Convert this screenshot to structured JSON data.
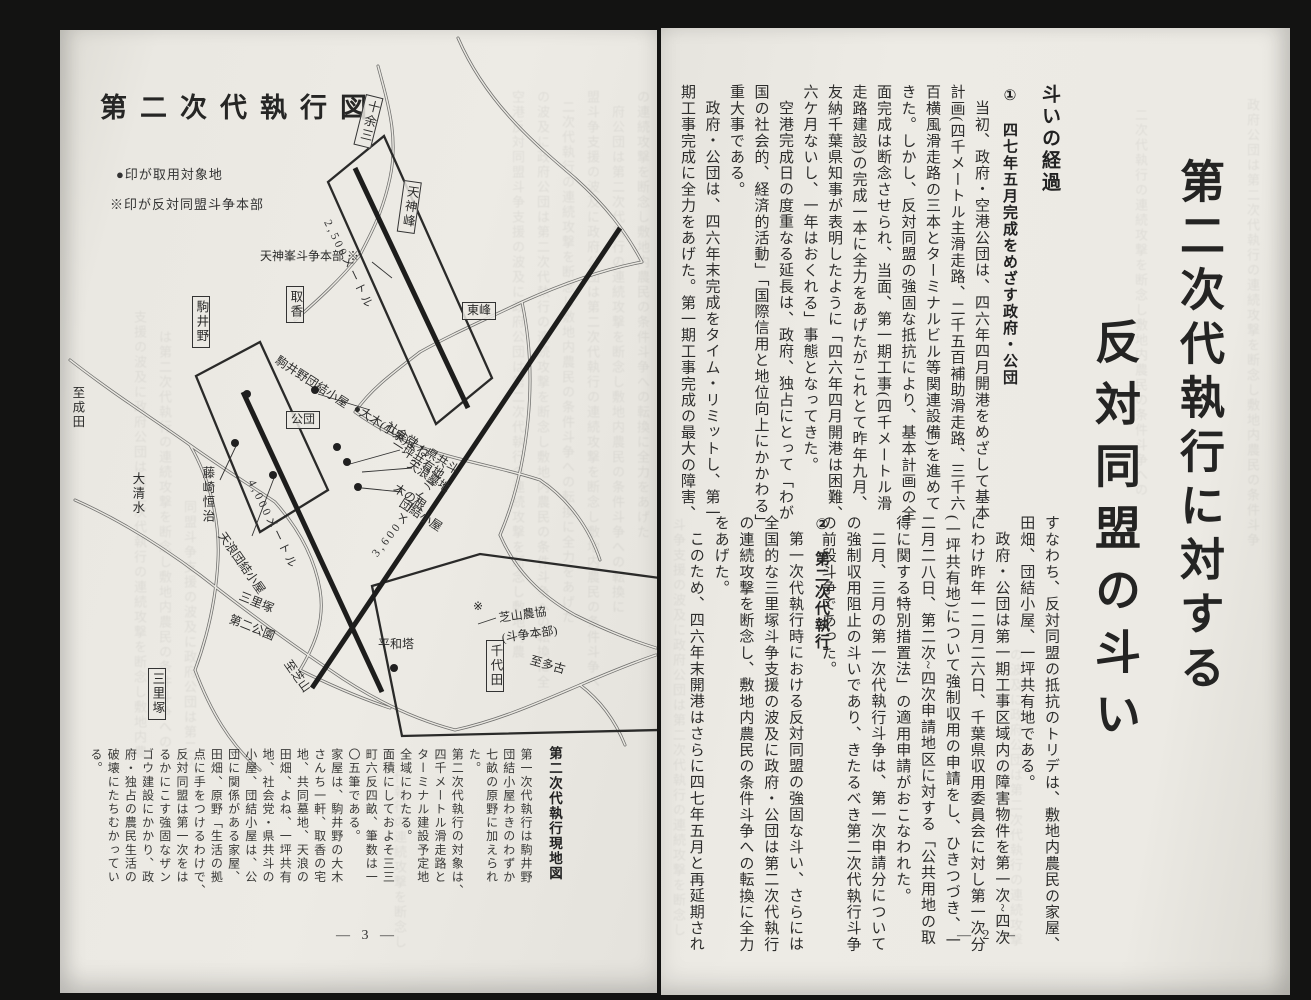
{
  "left_page": {
    "title": "第二次代執行図",
    "legend": [
      "●印が取用対象地",
      "※印が反対同盟斗争本部"
    ],
    "caption": "第二次代執行現地図",
    "page_num": "— 3 —",
    "bottom_cols": [
      "第一次代執行は駒井野",
      "団結小屋わきのわずか",
      "七畝の原野に加えられ",
      "た。",
      "第二次代執行の対象は、",
      "四千メートル滑走路と",
      "ターミナル建設予定地",
      "全域にわたる。",
      "面積にしておよそ三三",
      "町六反四畝、筆数は一",
      "〇五筆である。",
      "家屋は、駒井野の大木",
      "さんち一軒、取香の宅",
      "地、共同墓地、天浪の",
      "田畑、よね、一坪共有",
      "地、社会党・県共斗の",
      "小屋、団結小屋は、公",
      "団に関係がある家屋、",
      "田畑、原野「生活の拠",
      "点に手をつけるわけで、",
      "反対同盟は第一次をは",
      "るかにこす強固なザン",
      "ゴウ建設にかかり、政",
      "府・独占の農民生活の",
      "破壊にたちむかってい",
      "る。"
    ],
    "map": {
      "labels": [
        {
          "t": "十余三",
          "s": "box-v",
          "x": 306,
          "y": 64,
          "r": 14
        },
        {
          "t": "天神峰",
          "s": "box-v",
          "x": 344,
          "y": 150,
          "r": 8
        },
        {
          "t": "駒井野",
          "s": "box-v",
          "x": 132,
          "y": 266,
          "r": 0
        },
        {
          "t": "取香",
          "s": "box-v",
          "x": 226,
          "y": 256,
          "r": 0
        },
        {
          "t": "千代田",
          "s": "box-v",
          "x": 426,
          "y": 610,
          "r": 0
        },
        {
          "t": "三里塚",
          "s": "box-v",
          "x": 88,
          "y": 638,
          "r": 0
        },
        {
          "t": "東峰",
          "s": "box-h",
          "x": 402,
          "y": 272,
          "r": 0
        },
        {
          "t": "公団",
          "s": "box-h",
          "x": 226,
          "y": 381,
          "r": 0
        },
        {
          "t": "天神峯斗争本部 ※",
          "s": "h",
          "x": 200,
          "y": 220,
          "r": 0
        },
        {
          "t": "平和塔",
          "s": "h",
          "x": 318,
          "y": 608,
          "r": 0
        },
        {
          "t": "※",
          "s": "h",
          "x": 413,
          "y": 570,
          "r": 0
        },
        {
          "t": "芝山農協",
          "s": "h",
          "x": 438,
          "y": 582,
          "r": -8
        },
        {
          "t": "(斗争本部)",
          "s": "h",
          "x": 441,
          "y": 602,
          "r": -8
        },
        {
          "t": "至多古",
          "s": "h",
          "x": 472,
          "y": 624,
          "r": 16
        },
        {
          "t": "駒井野団結小屋",
          "s": "h",
          "x": 220,
          "y": 324,
          "r": 33
        },
        {
          "t": "●大木(小泉)よね",
          "s": "h",
          "x": 298,
          "y": 372,
          "r": 33
        },
        {
          "t": "社会党・県共斗",
          "s": "h",
          "x": 330,
          "y": 390,
          "r": 33
        },
        {
          "t": "一坪共有地",
          "s": "h",
          "x": 336,
          "y": 408,
          "r": 33
        },
        {
          "t": "天浪墓地",
          "s": "h",
          "x": 352,
          "y": 428,
          "r": 33
        },
        {
          "t": "木の根",
          "s": "h",
          "x": 338,
          "y": 452,
          "r": 33
        },
        {
          "t": "団結小屋",
          "s": "h",
          "x": 344,
          "y": 467,
          "r": 33
        },
        {
          "t": "三里塚",
          "s": "h",
          "x": 182,
          "y": 560,
          "r": 22
        },
        {
          "t": "第二公園",
          "s": "h",
          "x": 172,
          "y": 583,
          "r": 22
        },
        {
          "t": "至芝山",
          "s": "h",
          "x": 232,
          "y": 628,
          "r": 55
        },
        {
          "t": "2,500メートル",
          "s": "metric",
          "x": 272,
          "y": 188,
          "r": 64
        },
        {
          "t": "4,000メートル",
          "s": "metric",
          "x": 196,
          "y": 448,
          "r": 64
        },
        {
          "t": "3,600メートル",
          "s": "metric",
          "x": 310,
          "y": 522,
          "r": -52
        },
        {
          "t": "藤崎恒治",
          "s": "v",
          "x": 140,
          "y": 436,
          "r": 0
        },
        {
          "t": "天浪団結小屋",
          "s": "h",
          "x": 166,
          "y": 500,
          "r": 55
        },
        {
          "t": "大清水",
          "s": "v",
          "x": 70,
          "y": 442,
          "r": 0
        },
        {
          "t": "至成田",
          "s": "v",
          "x": 10,
          "y": 356,
          "r": 0
        }
      ],
      "dots": [
        [
          187,
          364
        ],
        [
          175,
          413
        ],
        [
          255,
          360
        ],
        [
          277,
          417
        ],
        [
          287,
          432
        ],
        [
          298,
          457
        ],
        [
          334,
          638
        ],
        [
          213,
          445
        ]
      ]
    }
  },
  "right_page": {
    "title_line1": "第二次代執行に対する",
    "title_line2": "反対同盟の斗い",
    "heading": "斗いの経過",
    "sections": [
      "①　四七年五月完成をめざす政府・公団",
      "②　第二次代執行"
    ],
    "page_num": "— 2 —",
    "upper_cols": [
      {
        "t": "当初、政府・空港公団は、四六年四月開港をめざして基本",
        "i": 1
      },
      {
        "t": "計画(四千メートル主滑走路、二千五百補助滑走路、三千六",
        "i": 0
      },
      {
        "t": "百横風滑走路の三本とターミナルビル等関連設備)を進めて",
        "i": 0
      },
      {
        "t": "きた。しかし、反対同盟の強固な抵抗により、基本計画の全",
        "i": 0
      },
      {
        "t": "面完成は断念させられ、当面、第一期工事(四千メートル滑",
        "i": 0
      },
      {
        "t": "走路建設)の完成一本に全力をあげたがこれとて昨年九月、",
        "i": 0
      },
      {
        "t": "友納千葉県知事が表明したように「四六年四月開港は困難、",
        "i": 0
      },
      {
        "t": "六ケ月ないし、一年はおくれる」事態となってきた。",
        "i": 0
      },
      {
        "t": "空港完成日の度重なる延長は、政府、独占にとって「わが",
        "i": 1
      },
      {
        "t": "国の社会的、経済的活動」「国際信用と地位向上にかかわる」",
        "i": 0
      },
      {
        "t": "重大事である。",
        "i": 0
      },
      {
        "t": "政府・公団は、四六年末完成をタイム・リミットし、第一",
        "i": 1
      },
      {
        "t": "期工事完成に全力をあげた。第一期工事完成の最大の障害、",
        "i": 0
      }
    ],
    "lower_cols_a": [
      {
        "t": "すなわち、反対同盟の抵抗のトリデは、敷地内農民の家屋、",
        "i": 0
      },
      {
        "t": "田畑、団結小屋、一坪共有地である。",
        "i": 0
      },
      {
        "t": "政府・公団は第一期工事区域内の障害物件を第一次~四次",
        "i": 1
      },
      {
        "t": "にわけ昨年一二月二六日、千葉県収用委員会に対し第一次分",
        "i": 0
      },
      {
        "t": "(一坪共有地)について強制収用の申請をし、ひきつづき、一",
        "i": 0
      },
      {
        "t": "二月二八日、第二次~四次申請地区に対する「公共用地の取",
        "i": 0
      },
      {
        "t": "得に関する特別措置法」の適用申請がおこなわれた。",
        "i": 0
      },
      {
        "t": "二月、三月の第一次代執行斗争は、第一次申請分について",
        "i": 1
      },
      {
        "t": "の強制収用阻止の斗いであり、きたるべき第二次代執行斗争",
        "i": 0
      },
      {
        "t": "の前段斗争であった。",
        "i": 0
      }
    ],
    "lower_cols_b": [
      {
        "t": "第一次代執行時における反対同盟の強固な斗い、さらには",
        "i": 1
      },
      {
        "t": "全国的な三里塚斗争支援の波及に政府・公団は第二次代執行",
        "i": 0
      },
      {
        "t": "の連続攻撃を断念し、敷地内農民の条件斗争への転換に全力",
        "i": 0
      },
      {
        "t": "をあげた。",
        "i": 0
      },
      {
        "t": "このため、四六年末開港はさらに四七年五月と再延期され",
        "i": 1
      }
    ]
  },
  "bleed": {
    "text": "空港反対同盟斗争支援の波及に政府公団は第二次代執行の連続攻撃を断念し敷地内農民の条件斗争への転換に全力をあげた"
  }
}
